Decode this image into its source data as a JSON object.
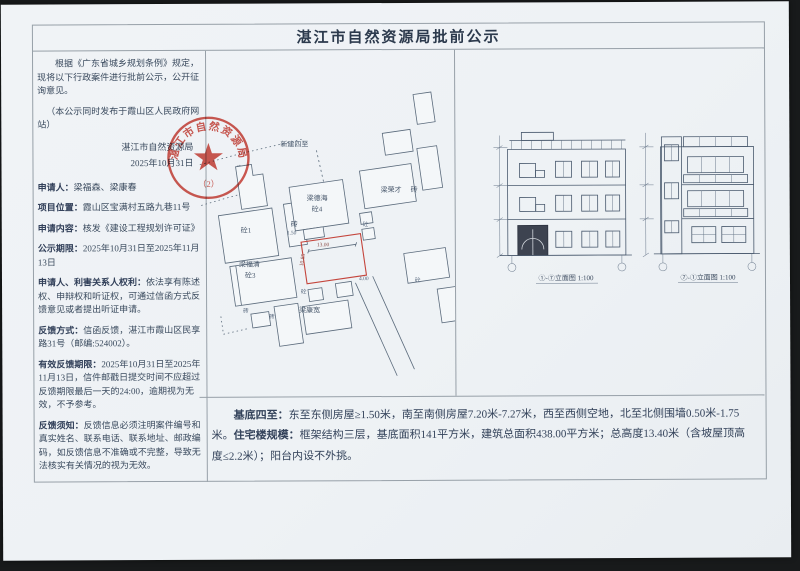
{
  "doc": {
    "title": "湛江市自然资源局批前公示",
    "intro": "根据《广东省城乡规划条例》规定，现将以下行政案件进行批前公示，公开征询意见。",
    "intro_note": "（本公示同时发布于霞山区人民政府网站）",
    "signature": {
      "org": "湛江市自然资源局",
      "date": "2025年10月31日"
    },
    "seal": {
      "ring_text": "湛江市自然资源局",
      "number": "（2）"
    },
    "fields": [
      {
        "label": "申请人：",
        "value": "梁福森、梁康春"
      },
      {
        "label": "项目位置：",
        "value": "霞山区宝满村五路九巷11号"
      },
      {
        "label": "申请内容：",
        "value": "核发《建设工程规划许可证》"
      },
      {
        "label": "公示期限：",
        "value": "2025年10月31日至2025年11月13日"
      },
      {
        "label": "申请人、利害关系人权利：",
        "value": "依法享有陈述权、申辩权和听证权，可通过信函方式反馈意见或者提出听证申请。"
      },
      {
        "label": "反馈方式：",
        "value": "信函反馈，湛江市霞山区民享路31号（邮编:524002）。"
      },
      {
        "label": "有效反馈期限：",
        "value": "2025年10月31日至2025年11月13日，信件邮戳日提交时间不应超过反馈期限最后一天的24:00，逾期视为无效，不予参考。"
      },
      {
        "label": "反馈须知：",
        "value": "反馈信息必须注明案件编号和真实姓名、联系电话、联系地址、邮政编码，如反馈信息不准确或不完整，导致无法核实有关情况的视为无效。"
      }
    ],
    "site_plan": {
      "area_label": "新建四至",
      "vacant_label": "空地",
      "labels": {
        "tong1": "砼1",
        "zhuan": "砖",
        "liangdehai": "梁德海",
        "tong4": "砼4",
        "liangfuqing": "梁福清",
        "tong3": "砼3",
        "liangrongcai": "梁荣才",
        "liangkangkuan": "梁康宽",
        "tong": "砼"
      },
      "dims": {
        "width": "13.00",
        "depth": "10.85",
        "side1": "1.50",
        "side2": "4.00"
      }
    },
    "elevations": {
      "caption_front": "①-⑦立面图 1:100",
      "caption_side": "⑦-①立面图 1:100"
    },
    "summary": {
      "label1": "基底四至：",
      "text1": "东至东侧房屋≥1.50米，南至南侧房屋7.20米-7.27米，西至西侧空地，北至北侧围墙0.50米-1.75米。",
      "label2": "住宅楼规模：",
      "text2": "框架结构三层，基底面积141平方米，建筑总面积438.00平方米；总高度13.40米（含坡屋顶高度≤2.2米）；阳台内设不外挑。"
    },
    "colors": {
      "seal_red": "#c9352c",
      "parcel_red": "#c4453c",
      "ink": "#37455a"
    }
  }
}
